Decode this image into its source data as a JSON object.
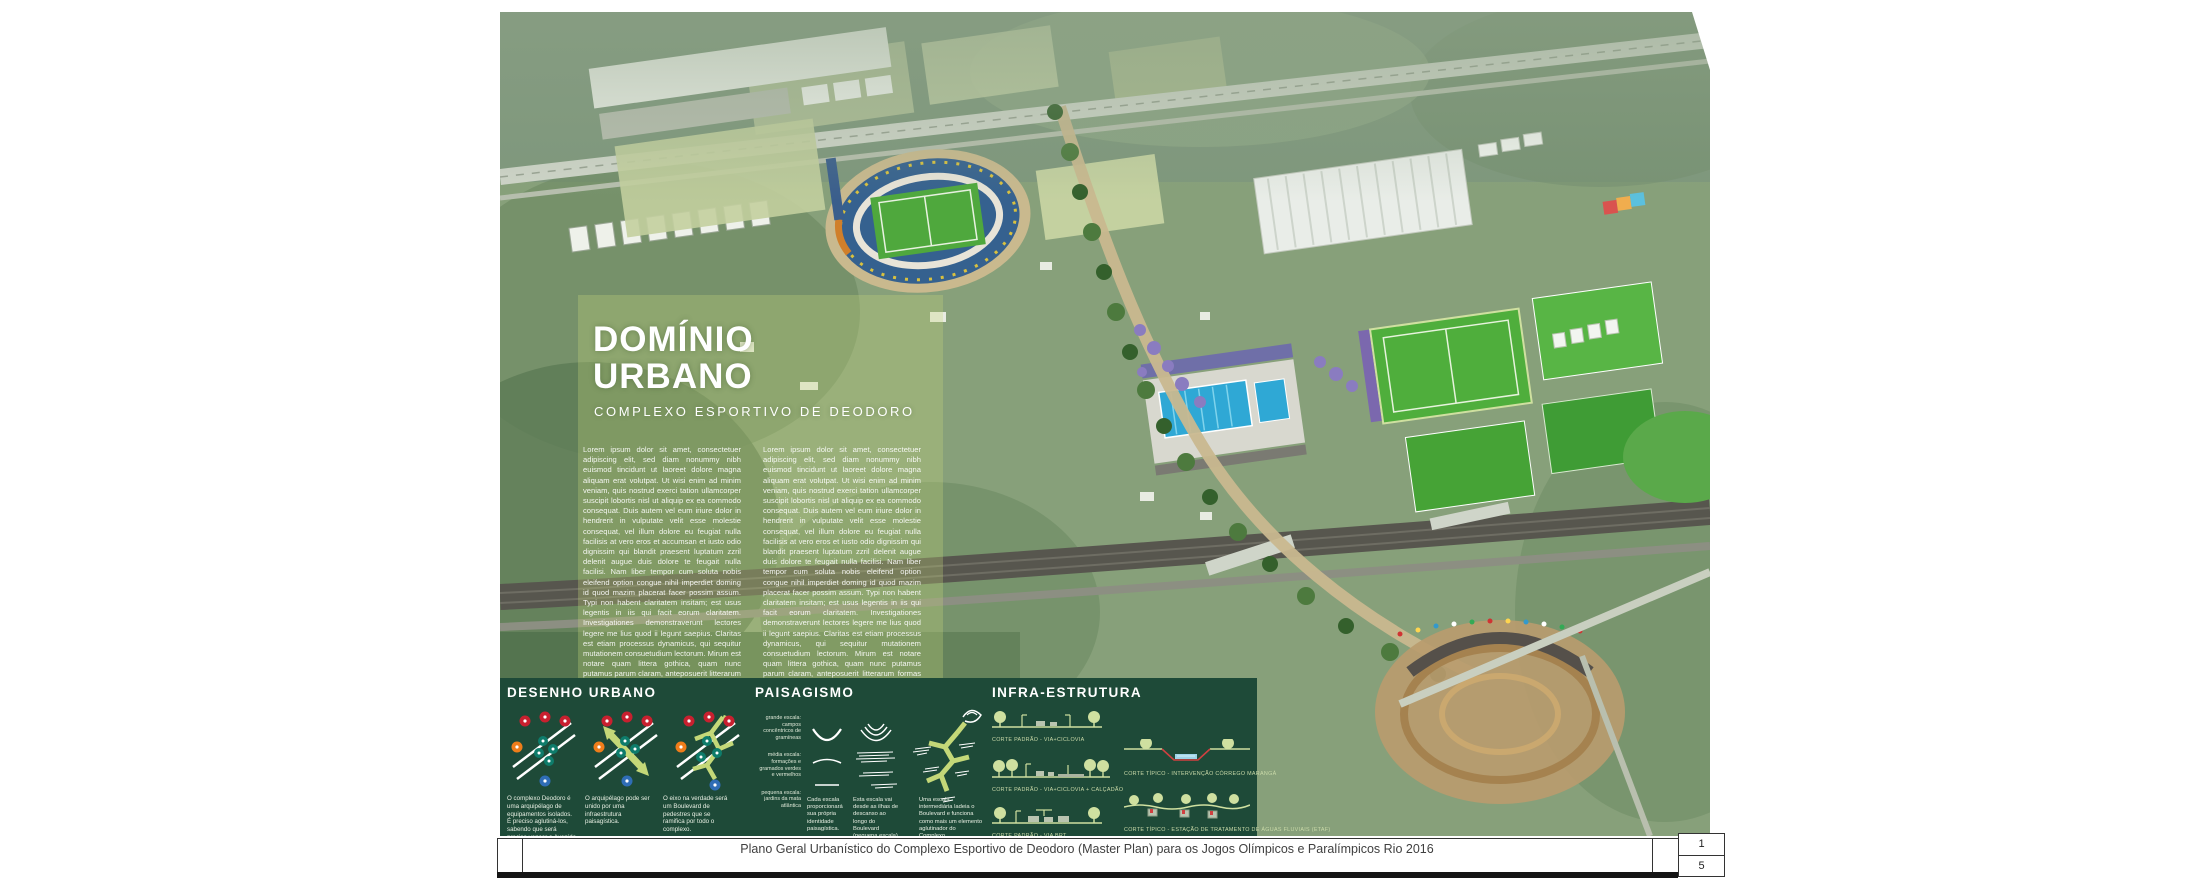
{
  "poster": {
    "title_line1": "DOMÍNIO",
    "title_line2": "URBANO",
    "subtitle": "COMPLEXO ESPORTIVO DE DEODORO",
    "body_col1": "Lorem ipsum dolor sit amet, consectetuer adipiscing elit, sed diam nonummy nibh euismod tincidunt ut laoreet dolore magna aliquam erat volutpat. Ut wisi enim ad minim veniam, quis nostrud exerci tation ullamcorper suscipit lobortis nisl ut aliquip ex ea commodo consequat. Duis autem vel eum iriure dolor in hendrerit in vulputate velit esse molestie consequat, vel illum dolore eu feugiat nulla facilisis at vero eros et accumsan et iusto odio dignissim qui blandit praesent luptatum zzril delenit augue duis dolore te feugait nulla facilisi. Nam liber tempor cum soluta nobis eleifend option congue nihil imperdiet doming id quod mazim placerat facer possim assum. Typi non habent claritatem insitam; est usus legentis in iis qui facit eorum claritatem. Investigationes demonstraverunt lectores legere me lius quod ii legunt saepius. Claritas est etiam processus dynamicus, qui sequitur mutationem consuetudium lectorum. Mirum est notare quam littera gothica, quam nunc putamus parum claram, anteposuerit litterarum formas humanitatis per seacula quarta decima et quinta decima. Eodem modo typi, qui nunc nobis videntur parum clari, fiant sollemnes in futurum.",
    "body_col2": "Lorem ipsum dolor sit amet, consectetuer adipiscing elit, sed diam nonummy nibh euismod tincidunt ut laoreet dolore magna aliquam erat volutpat. Ut wisi enim ad minim veniam, quis nostrud exerci tation ullamcorper suscipit lobortis nisl ut aliquip ex ea commodo consequat. Duis autem vel eum iriure dolor in hendrerit in vulputate velit esse molestie consequat, vel illum dolore eu feugiat nulla facilisis at vero eros et iusto odio dignissim qui blandit praesent luptatum zzril delenit augue duis dolore te feugait nulla facilisi. Nam liber tempor cum soluta nobis eleifend option congue nihil imperdiet doming id quod mazim placerat facer possim assum. Typi non habent claritatem insitam; est usus legentis in iis qui facit eorum claritatem. Investigationes demonstraverunt lectores legere me lius quod ii legunt saepius. Claritas est etiam processus dynamicus, qui sequitur mutationem consuetudium lectorum. Mirum est notare quam littera gothica, quam nunc putamus parum claram, anteposuerit litterarum formas humanitatis per seacula quarta decima. Eodem modo typi, qui nunc nobis videntur parum clari, fiant sollemnes in futurum."
  },
  "panel": {
    "desenho": {
      "title": "DESENHO URBANO",
      "captions": [
        "O complexo Deodoro é uma arquipélago de equipamentos isolados. É preciso aglutiná-los, sabendo que será preciso vencer a Avenida Brasil e a ferrovia.",
        "O arquipélago pode ser unido por uma infraestrutura paisagística.",
        "O eixo na verdade será um Boulevard de pedestres que se ramifica por todo o complexo."
      ]
    },
    "paisagismo": {
      "title": "PAISAGISMO",
      "scales": [
        "grande escala: campos concêntricos de gramíneas",
        "média escala: formações e gramados verdes e vermelhos",
        "pequena escala: jardins da mata atlântica"
      ],
      "captions": [
        "Cada escala proporcionará sua própria identidade paisagística.",
        "Esta escala vai desde as ilhas de descanso ao longo do Boulevard (pequena escala) até os enormes campos concêntricos do Parque radial.",
        "Uma escala intermediária ladeia o Boulevard e funciona como mais um elemento aglutinador do Complexo."
      ]
    },
    "infra": {
      "title": "INFRA-ESTRUTURA",
      "cortes": [
        "CORTE PADRÃO - VIA+CICLOVIA",
        "CORTE PADRÃO - VIA+CICLOVIA + CALÇADÃO",
        "CORTE PADRÃO - VIA BRT",
        "CORTE TÍPICO - INTERVENÇÃO CÓRREGO MARANGÁ",
        "CORTE TÍPICO - ESTAÇÃO DE TRATAMENTO DE ÁGUAS FLUVIAIS (ETAF)"
      ]
    }
  },
  "footer": {
    "caption": "Plano Geral Urbanístico do Complexo Esportivo de Deodoro (Master Plan) para os Jogos Olímpicos e Paralímpicos Rio 2016",
    "page_top": "1",
    "page_bottom": "5"
  },
  "colors": {
    "panel_green": "#1e4a38",
    "accent_red": "#c8202f",
    "accent_teal": "#0e7c6b",
    "accent_orange": "#ef7d1a",
    "accent_blue": "#2f6db6",
    "accent_lime": "#c4d878",
    "pool_blue": "#2fa8d5"
  }
}
